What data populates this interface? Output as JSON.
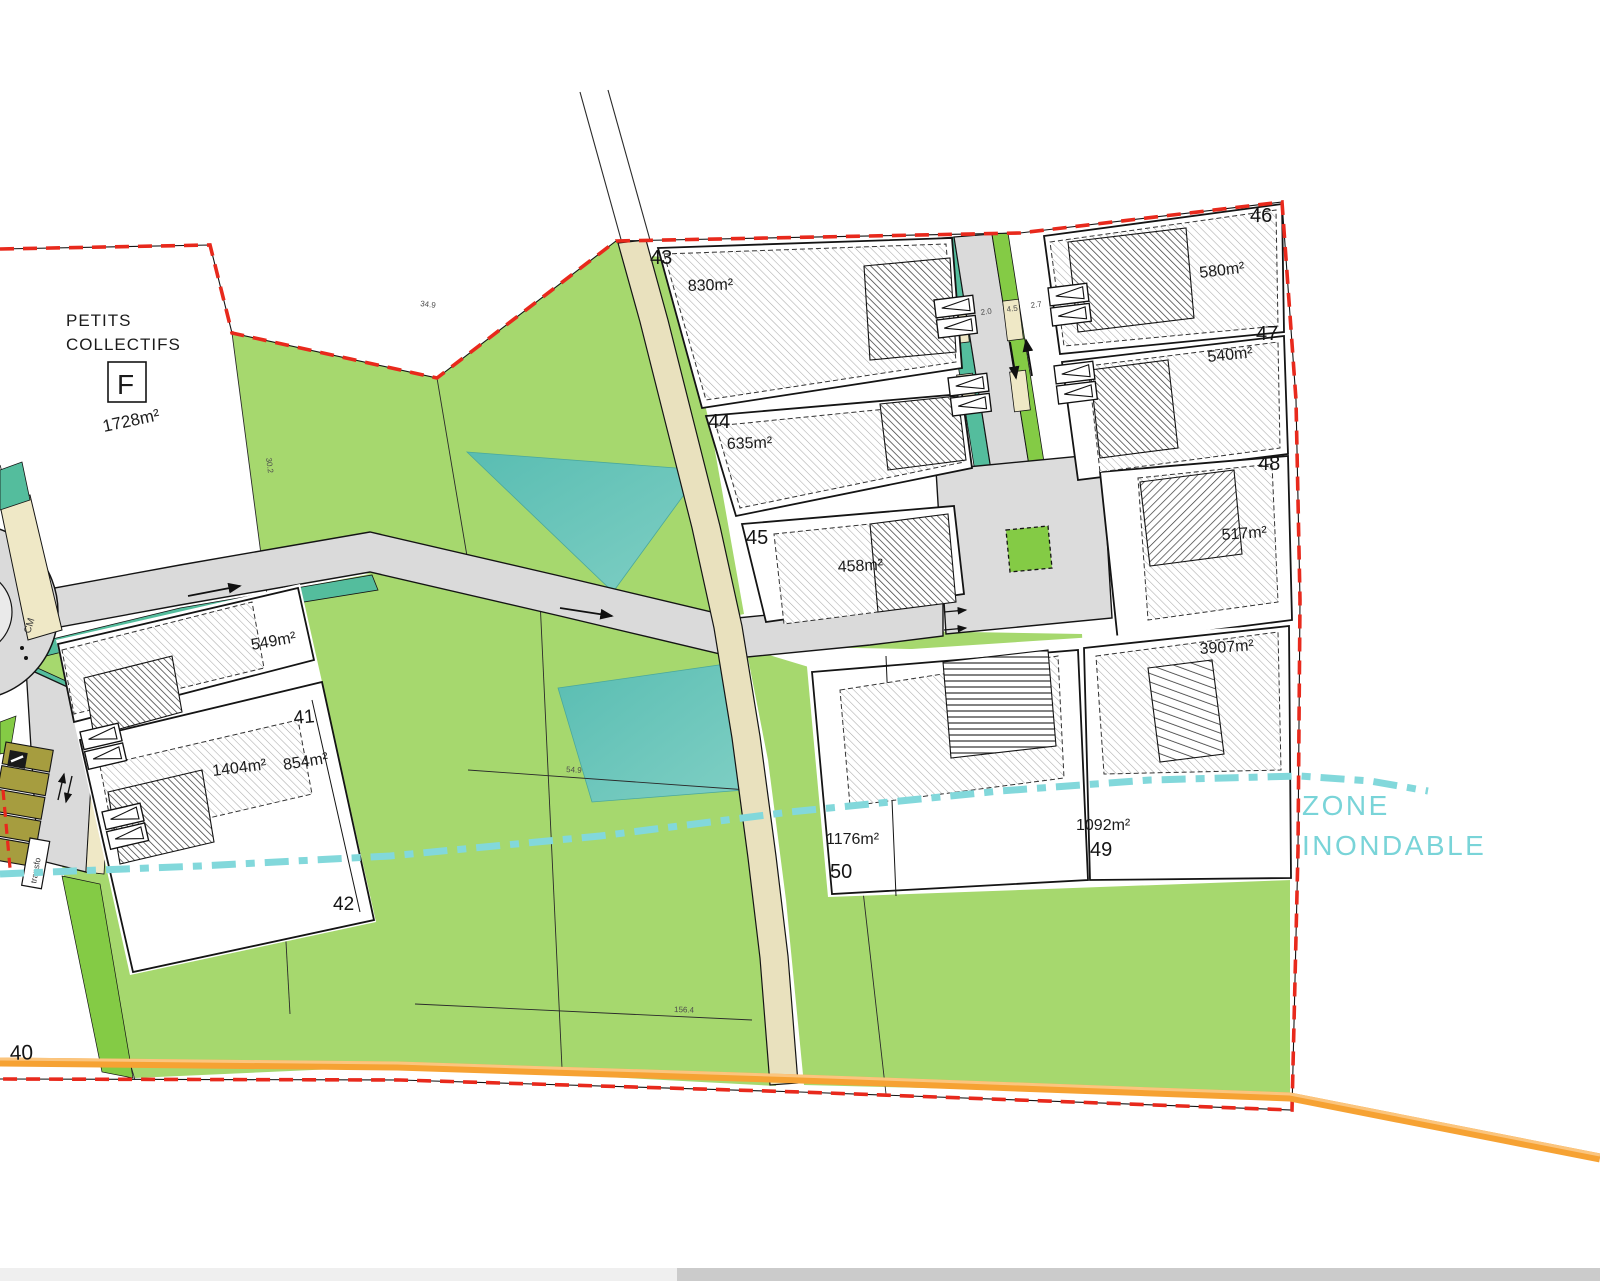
{
  "plan": {
    "collectifs": {
      "line1": "PETITS",
      "line2": "COLLECTIFS",
      "building_label": "F",
      "area": "1728m²"
    },
    "flood_zone": {
      "line1": "ZONE",
      "line2": "INONDABLE"
    },
    "parcels": {
      "p40": {
        "number": "40"
      },
      "p41": {
        "number": "41",
        "area": "549m²"
      },
      "p42": {
        "number": "42",
        "area_a": "1404m²",
        "area_b": "854m²"
      },
      "p43": {
        "number": "43",
        "area": "830m²"
      },
      "p44": {
        "number": "44",
        "area": "635m²"
      },
      "p45": {
        "number": "45",
        "area": "458m²"
      },
      "p46": {
        "number": "46",
        "area": "580m²"
      },
      "p47": {
        "number": "47",
        "area": "540m²"
      },
      "p48": {
        "number": "48",
        "area": "517m²"
      },
      "p49": {
        "number": "49",
        "area": "1092m²"
      },
      "p50": {
        "number": "50",
        "area": "1176m²"
      },
      "large_parcel": {
        "area": "3907m²"
      }
    },
    "annotations": {
      "rural_path": "CM",
      "transformer": "transfo"
    },
    "dimensions": {
      "boundary_top": "34.9",
      "field_width": "54.9",
      "field_length": "156.4",
      "parcel_side": "30.2",
      "lane_left": "2.0",
      "lane_center": "4.5",
      "lane_right": "2.7"
    },
    "colors": {
      "field_green": "#A6D86E",
      "verge_green": "#84CB45",
      "verge_teal": "#54BD9D",
      "pond_teal": "#5EC1B6",
      "path_beige": "#E9E1BE",
      "road_gray": "#DADADA",
      "boundary_red": "#E8291C",
      "limit_orange": "#F6A233",
      "flood_cyan": "#82D8DB",
      "parking_olive": "#A69D3F"
    }
  }
}
